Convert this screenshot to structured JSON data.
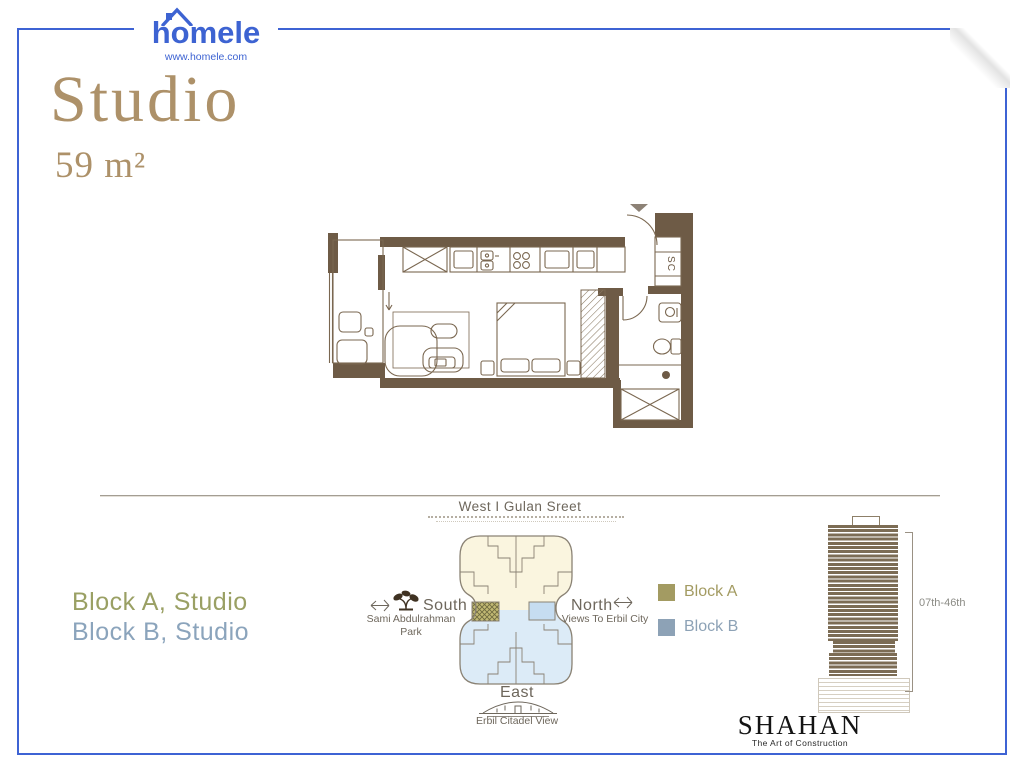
{
  "brand": {
    "logo_text": "homele",
    "website": "www.homele.com"
  },
  "unit": {
    "type": "Studio",
    "area": "59 m²"
  },
  "floor_plan": {
    "shaft_label": "SC"
  },
  "site_plan": {
    "street_label": "West I Gulan Sreet",
    "south": {
      "label": "South",
      "line1": "Sami Abdulrahman",
      "line2": "Park"
    },
    "north": {
      "label": "North",
      "description": "Views To Erbil City"
    },
    "east": {
      "label": "East",
      "description": "Erbil Citadel View"
    }
  },
  "blocks": {
    "a": "Block A, Studio",
    "b": "Block B, Studio"
  },
  "legend": {
    "a": {
      "label": "Block A",
      "color": "#a39b62"
    },
    "b": {
      "label": "Block B",
      "color": "#8da2b6"
    }
  },
  "elevation": {
    "floors": "07th-46th"
  },
  "developer": {
    "name": "SHAHAN",
    "tagline": "The Art of Construction"
  },
  "colors": {
    "frame_blue": "#3e63d4",
    "title_tan": "#ad9169",
    "plan_brown": "#6e5b46",
    "block_a_olive": "#9aa064",
    "block_b_blue": "#8ba4bc",
    "site_cream": "#faf5df",
    "site_light_blue": "#dcebf7"
  }
}
